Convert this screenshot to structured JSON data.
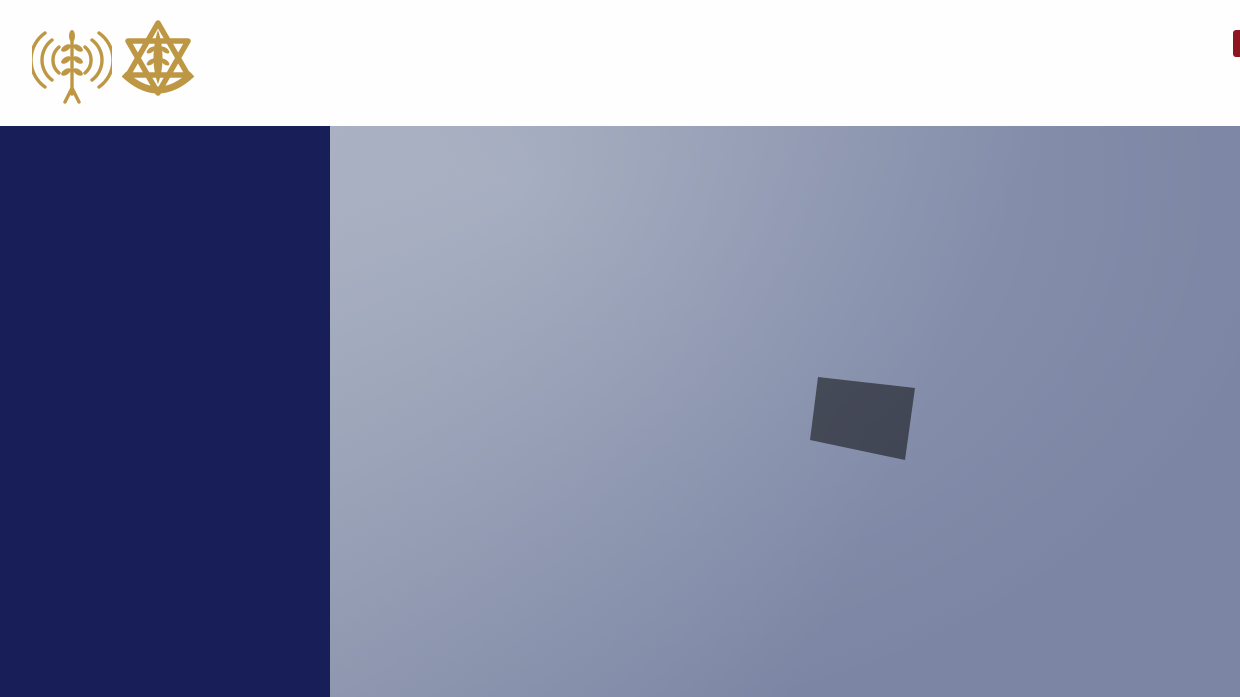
{
  "header": {
    "line1": "للمتواجدين في الضاحية الجنوبية: لكل من يتواجد في المبنى المحدد",
    "line2": "ق ما يُعرض في الخارطة والمباني القريبة منه في برج البراجنة"
  },
  "logos": {
    "left_icon": "broadcast-tower-olive-branch-icon",
    "right_icon": "idf-star-emblem-icon"
  },
  "sidebar": {
    "lines": [
      [
        {
          "t": "أنتم متواجدون بالقرب من",
          "h": false
        }
      ],
      [
        {
          "t": "منشآت تابعة لحزب الله,",
          "h": false
        }
      ],
      [
        {
          "t": "فمن أجل سلامتكم وسلامة",
          "h": false
        }
      ],
      [
        {
          "t": "أبناء عائلاتكم, أنتم مضطرون",
          "h": false
        }
      ],
      [
        {
          "t": "لإخلاء هذه المباني",
          "h": false
        }
      ],
      [
        {
          "t": "فورًا والابتعاد عنها",
          "h": true
        }
      ],
      [
        {
          "t": "لمسافة 500 متر ",
          "h": true
        },
        {
          "t": "وفق ما",
          "h": false
        }
      ],
      [
        {
          "t": "يُعرض في الخارطة.",
          "h": false
        }
      ]
    ]
  },
  "map": {
    "building_label": "مسجد و مجمع امير المومنين",
    "marked_zones": [
      "white-outlined-building",
      "red-target-building"
    ]
  },
  "colors": {
    "header_text": "#8e1420",
    "sidebar_bg": "#181e57",
    "highlight_red": "#b5151b",
    "target_red_stroke": "#e51f26",
    "target_red_fill": "#d61c24",
    "outline_white": "#ffffff",
    "logo_gold": "#bd9743"
  }
}
